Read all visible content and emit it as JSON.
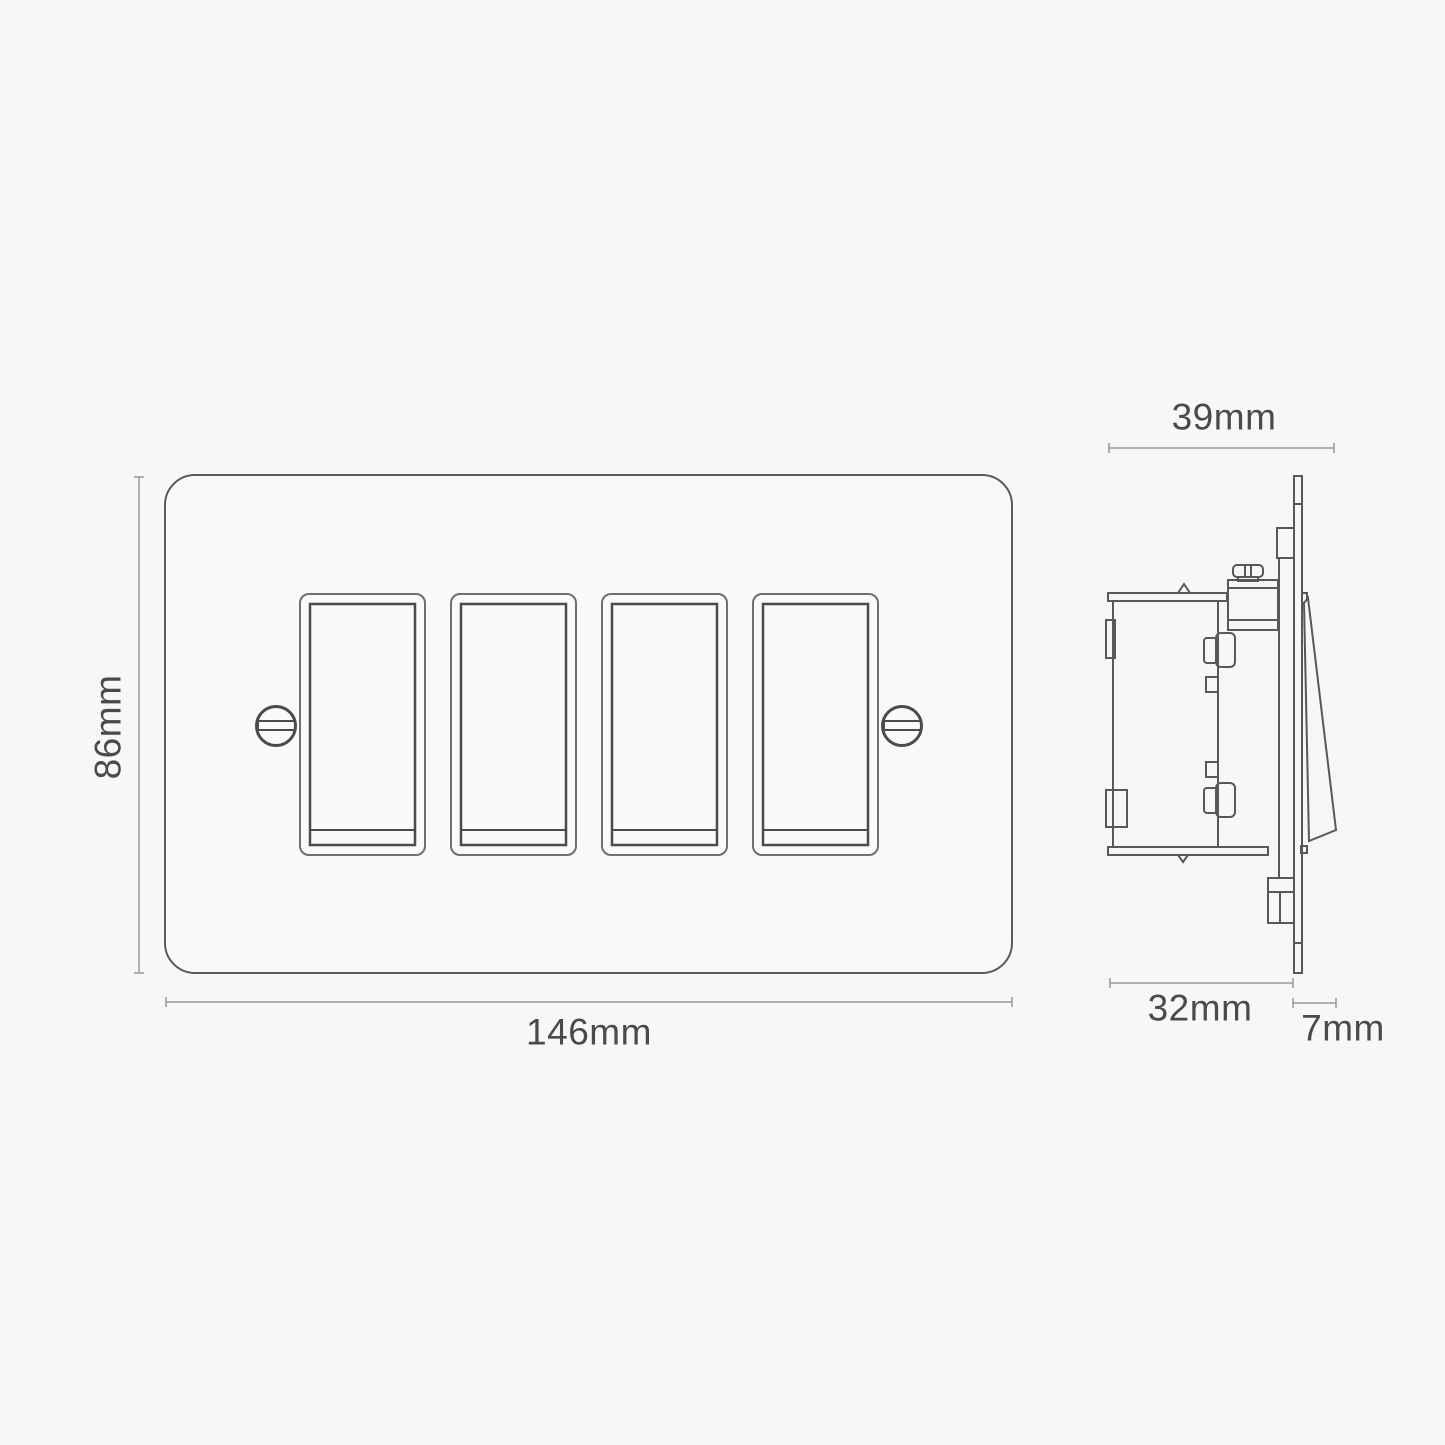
{
  "front_view": {
    "rocker_count": 4,
    "width_label": "146mm",
    "height_label": "86mm"
  },
  "side_view": {
    "overall_depth_label": "39mm",
    "box_depth_label": "32mm",
    "projection_label": "7mm"
  },
  "colors": {
    "background": "#f7f7f7",
    "line_dark": "#4b4b4b",
    "line_medium": "#6f6f6f",
    "plate_outline": "#5a5a5a",
    "dimension_line": "#98989b",
    "label_text": "#4a4a4d"
  }
}
